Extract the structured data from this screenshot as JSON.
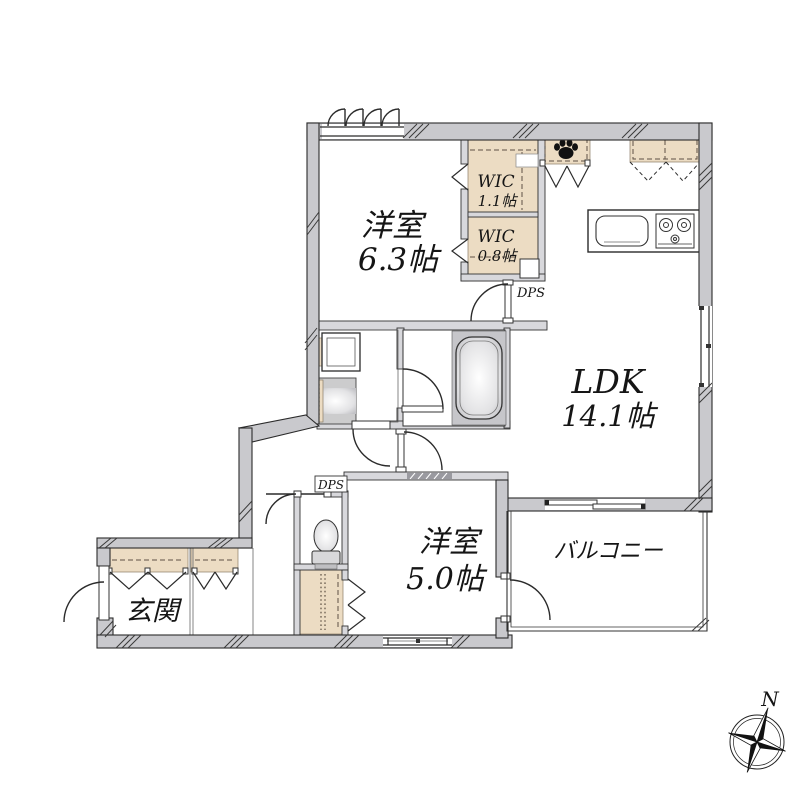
{
  "rooms": {
    "bedroom1": {
      "name": "洋室",
      "size": "6.3帖"
    },
    "wic1": {
      "name": "WIC",
      "size": "1.1帖"
    },
    "wic2": {
      "name": "WIC",
      "size": "0.8帖"
    },
    "ldk": {
      "name": "LDK",
      "size": "14.1帖"
    },
    "bedroom2": {
      "name": "洋室",
      "size": "5.0帖"
    },
    "balcony": {
      "name": "バルコニー"
    },
    "entrance": {
      "name": "玄関"
    }
  },
  "labels": {
    "dps_upper": "DPS",
    "dps_lower": "DPS"
  },
  "compass": {
    "north": "N"
  },
  "colors": {
    "outer_wall_fill": "#c9c9cd",
    "interior_wall_fill": "#d8d8dc",
    "fixture_beige": "#ecdcc3",
    "fixture_gray": "#c6c6ca",
    "line": "#2b2b2b"
  }
}
